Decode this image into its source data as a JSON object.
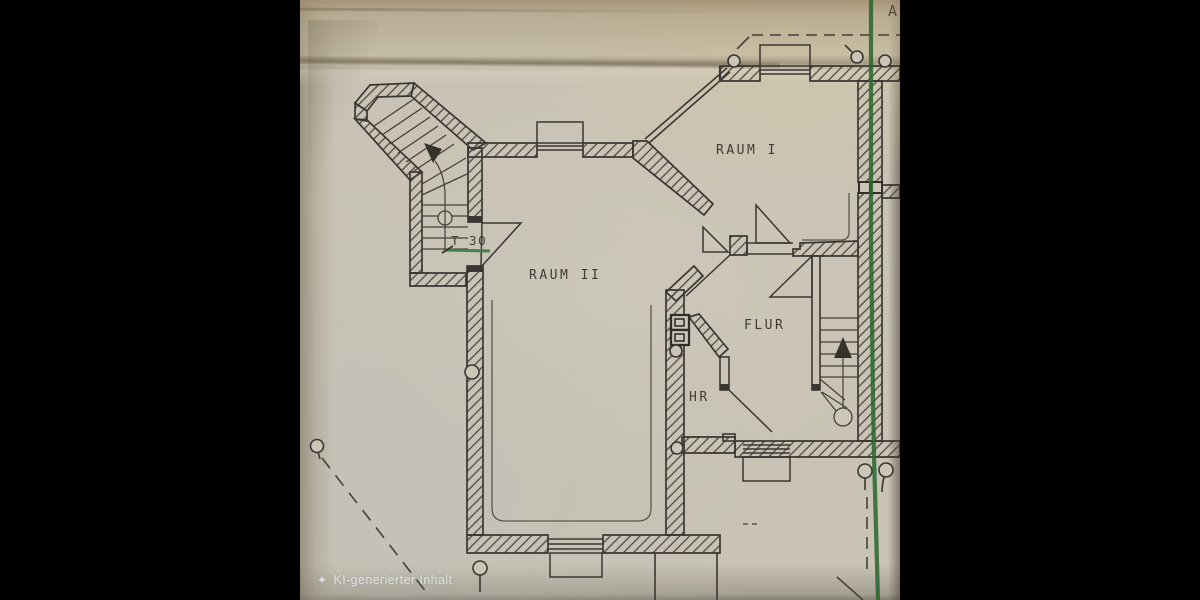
{
  "canvas": {
    "width": 1200,
    "height": 600,
    "letterbox_color": "#000000",
    "photo_left": 300,
    "photo_width": 600
  },
  "paper": {
    "base_color": "#c8c3b4",
    "ink_color": "#3a3733",
    "green_line_color": "#2b6830",
    "underline_green": "#3e7d40"
  },
  "plan": {
    "rooms": [
      {
        "label": "RAUM I"
      },
      {
        "label": "RAUM II"
      },
      {
        "label": "FLUR"
      },
      {
        "label": "HR"
      }
    ],
    "door_label": "T 30",
    "grid_marker": "A",
    "features": [
      "stair-tower-top-left",
      "stair-right",
      "chimney-block",
      "window-openings",
      "door-swings",
      "survey-circle-markers",
      "dashed-boundary-lines",
      "green-section-line"
    ]
  },
  "watermark": {
    "icon": "sparkle-icon",
    "icon_glyph": "✦",
    "text": "KI-generierter Inhalt"
  }
}
